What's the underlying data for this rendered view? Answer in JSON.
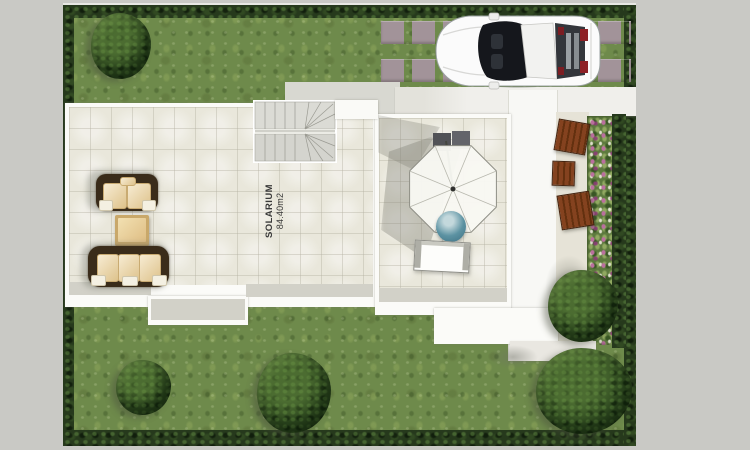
{
  "meta": {
    "type_label": "architectural-site-plan",
    "view_label": "top-down-render"
  },
  "labels": {
    "room_name": "SOLARIUM",
    "room_area": "84.40m2"
  },
  "plan": {
    "colors": {
      "canvas": "#c9c9c5",
      "grass": "#6e8a4b",
      "hedge": "#26391c",
      "terrace-tile": "#e9e7db",
      "path-white": "#f8f8f5",
      "paver": "#a29399",
      "step-shadow": "#d2d1c8",
      "sofa-frame": "#3a2c1a",
      "sofa-cushion": "#efd8a6",
      "ottoman": "#c9a86a",
      "wood-deck": "#84421f",
      "chair-teal": "#5c92a2",
      "flower-pink": "#bb6f9f",
      "car-body": "#fbfbfb",
      "car-glass": "#15171c",
      "car-tail": "#8e2126"
    },
    "objects": [
      {
        "name": "lawn"
      },
      {
        "name": "perimeter-hedge"
      },
      {
        "name": "driveway-pavers"
      },
      {
        "name": "sports-car"
      },
      {
        "name": "winder-staircase"
      },
      {
        "name": "solarium-terrace"
      },
      {
        "name": "two-seat-sofa"
      },
      {
        "name": "three-seat-sofa"
      },
      {
        "name": "ottoman-table"
      },
      {
        "name": "parasol-umbrella"
      },
      {
        "name": "parasol-base"
      },
      {
        "name": "round-chair"
      },
      {
        "name": "side-table"
      },
      {
        "name": "garden-path"
      },
      {
        "name": "flower-bed"
      },
      {
        "name": "wood-deck-tiles"
      },
      {
        "name": "garden-shrubs"
      }
    ]
  }
}
